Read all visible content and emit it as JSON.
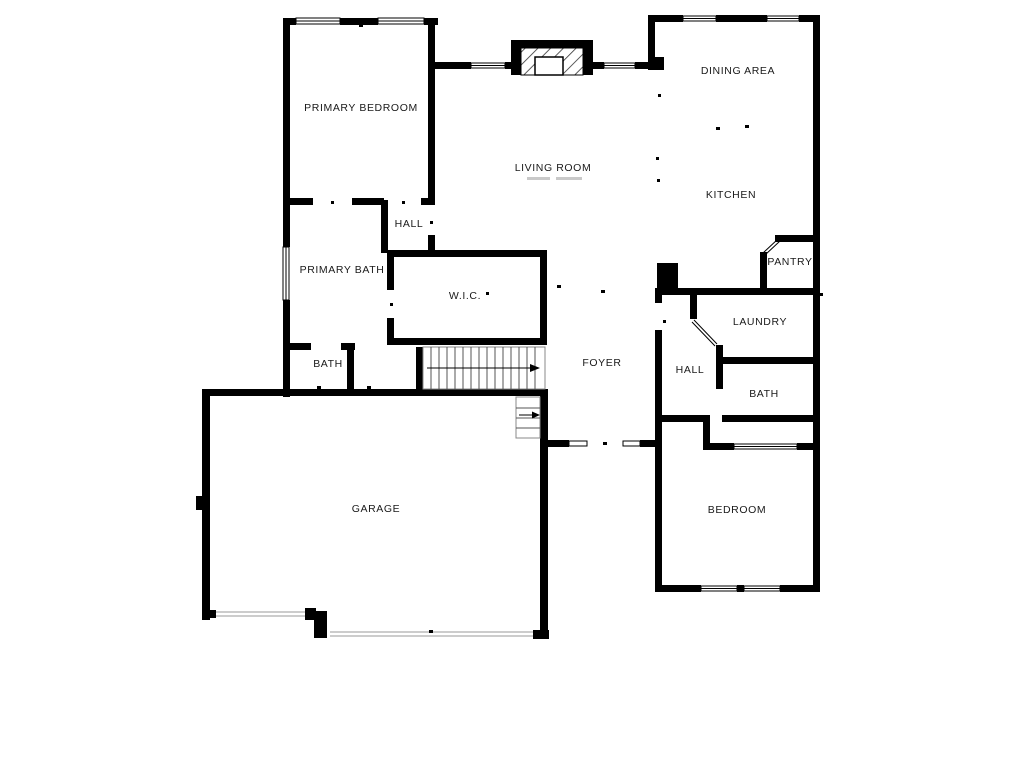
{
  "plan": {
    "type": "floor-plan",
    "rooms": [
      {
        "id": "primary-bedroom",
        "label": "PRIMARY BEDROOM"
      },
      {
        "id": "living-room",
        "label": "LIVING ROOM"
      },
      {
        "id": "dining-area",
        "label": "DINING AREA"
      },
      {
        "id": "kitchen",
        "label": "KITCHEN"
      },
      {
        "id": "pantry",
        "label": "PANTRY"
      },
      {
        "id": "hall-upper",
        "label": "HALL"
      },
      {
        "id": "primary-bath",
        "label": "PRIMARY BATH"
      },
      {
        "id": "wic",
        "label": "W.I.C."
      },
      {
        "id": "bath-left",
        "label": "BATH"
      },
      {
        "id": "foyer",
        "label": "FOYER"
      },
      {
        "id": "hall-lower",
        "label": "HALL"
      },
      {
        "id": "laundry",
        "label": "LAUNDRY"
      },
      {
        "id": "bath-right",
        "label": "BATH"
      },
      {
        "id": "garage",
        "label": "GARAGE"
      },
      {
        "id": "bedroom",
        "label": "BEDROOM"
      }
    ],
    "colors": {
      "wall": "#000000",
      "background": "#ffffff",
      "label": "#1a1a1a"
    }
  }
}
